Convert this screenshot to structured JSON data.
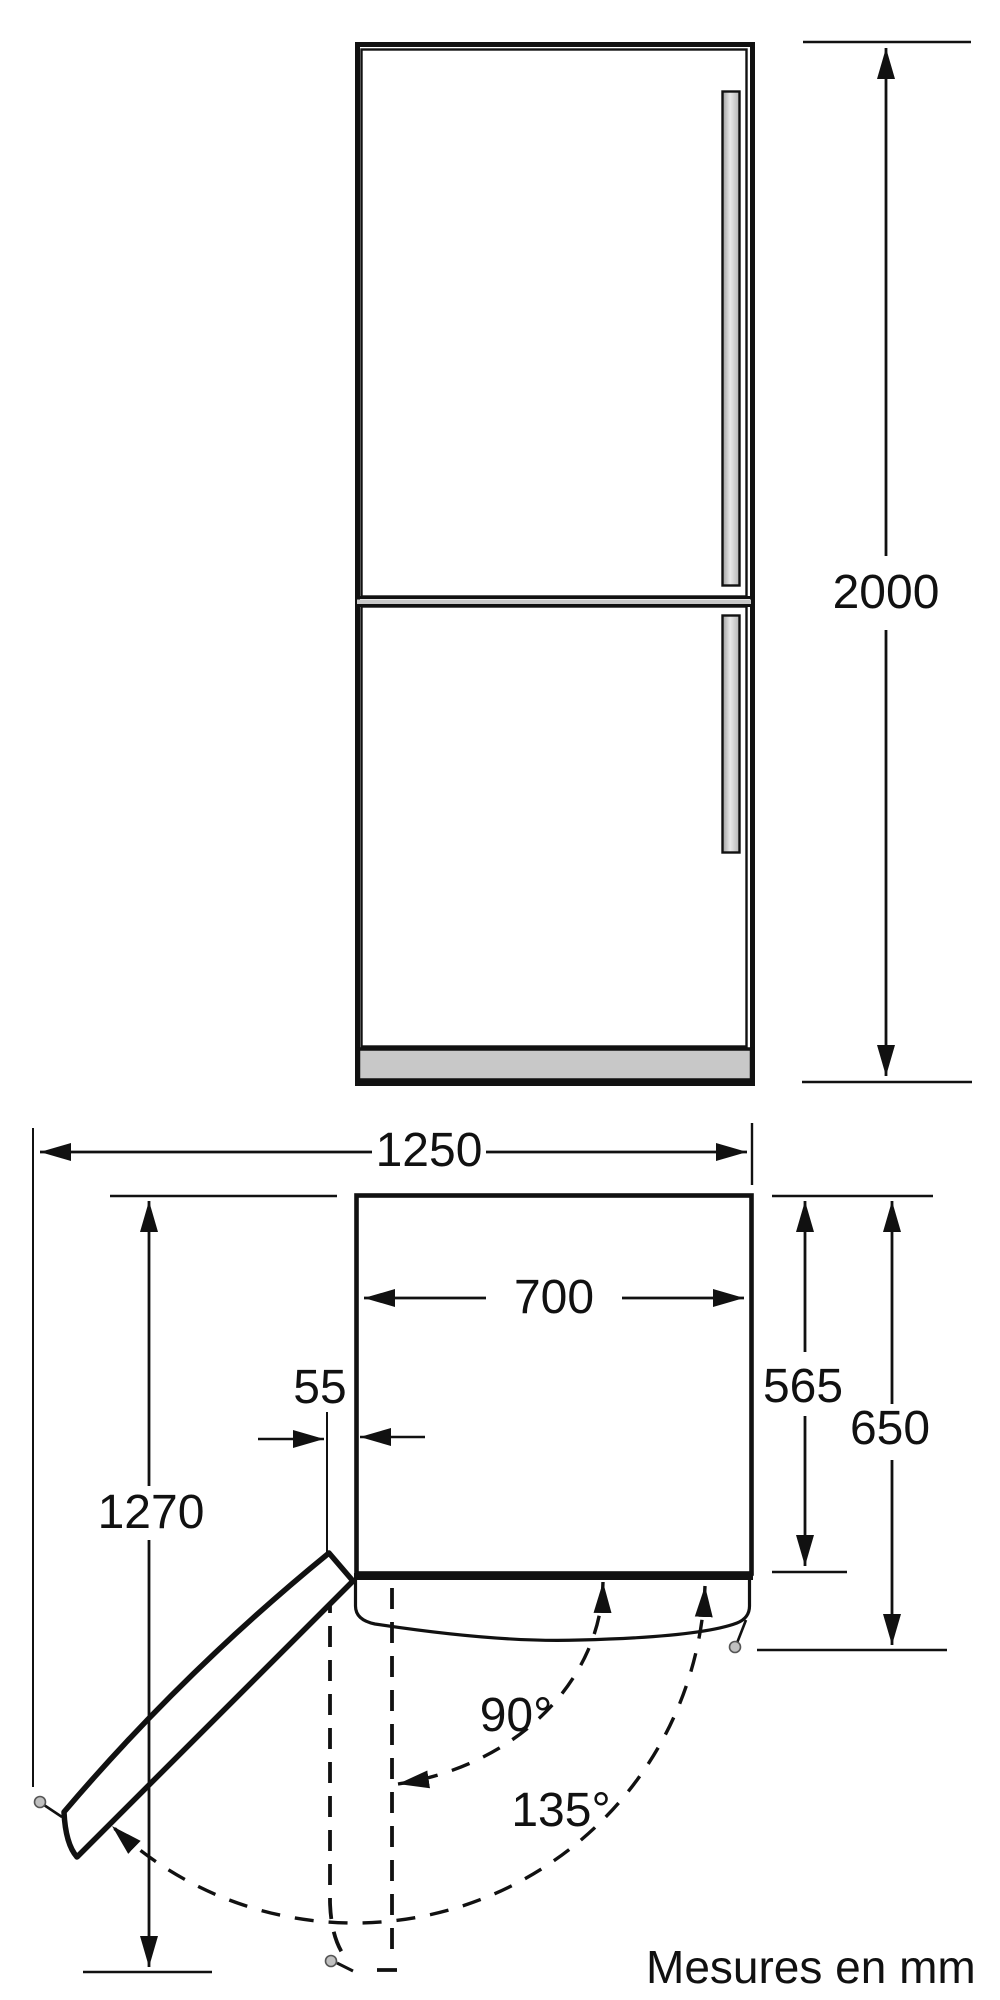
{
  "diagram": {
    "type": "appliance-dimension-drawing",
    "dimensions": {
      "total_height": "2000",
      "total_width_door_open": "1250",
      "cabinet_width": "700",
      "door_side_clearance": "55",
      "cabinet_depth": "565",
      "total_depth": "650",
      "door_swing_reach": "1270",
      "door_angle_90": "90°",
      "door_angle_135": "135°"
    },
    "footer": {
      "units_note": "Mesures en mm"
    },
    "colors": {
      "line": "#111111",
      "gray_fill": "#c8c8c8",
      "pin_fill": "#c0c0c0",
      "bg": "#ffffff"
    }
  }
}
